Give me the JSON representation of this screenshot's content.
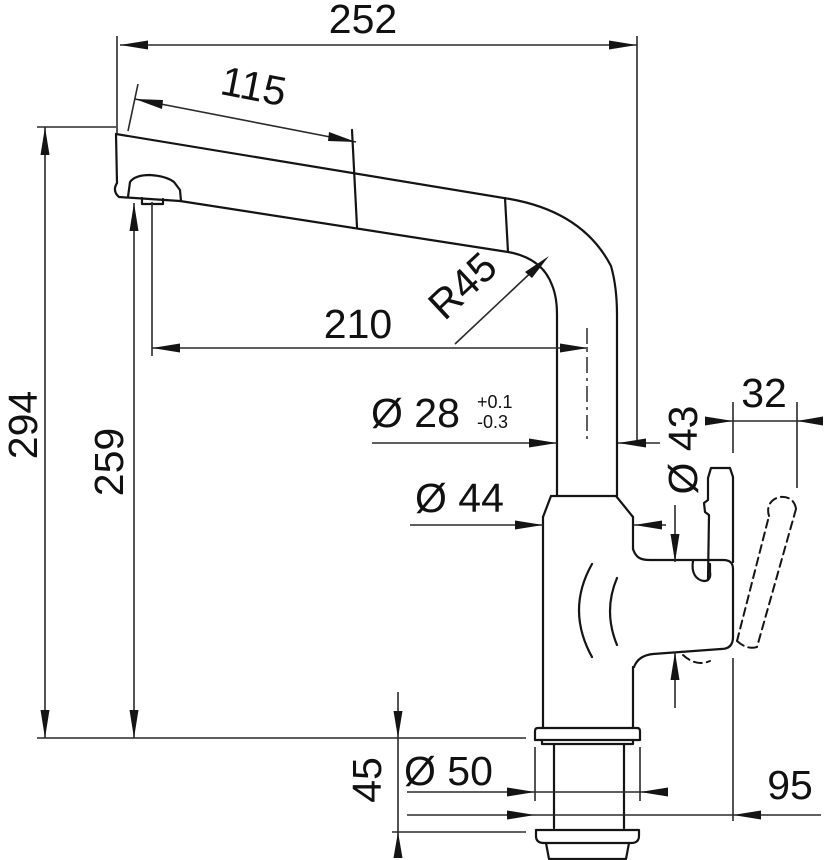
{
  "drawing": {
    "background": "#ffffff",
    "line_color": "#141414",
    "dims": {
      "overall_reach": "252",
      "handspray_length": "115",
      "overall_height": "294",
      "outlet_height": "259",
      "reach_to_axis": "210",
      "bend_radius": "R45",
      "column_diameter": "Ø 28",
      "column_tol_plus": "+0.1",
      "column_tol_minus": "-0.3",
      "cartridge_diameter": "Ø 43",
      "body_diameter": "Ø 44",
      "lever_travel": "32",
      "base_diameter": "Ø 50",
      "shank_height": "45",
      "lever_reach": "95"
    }
  }
}
